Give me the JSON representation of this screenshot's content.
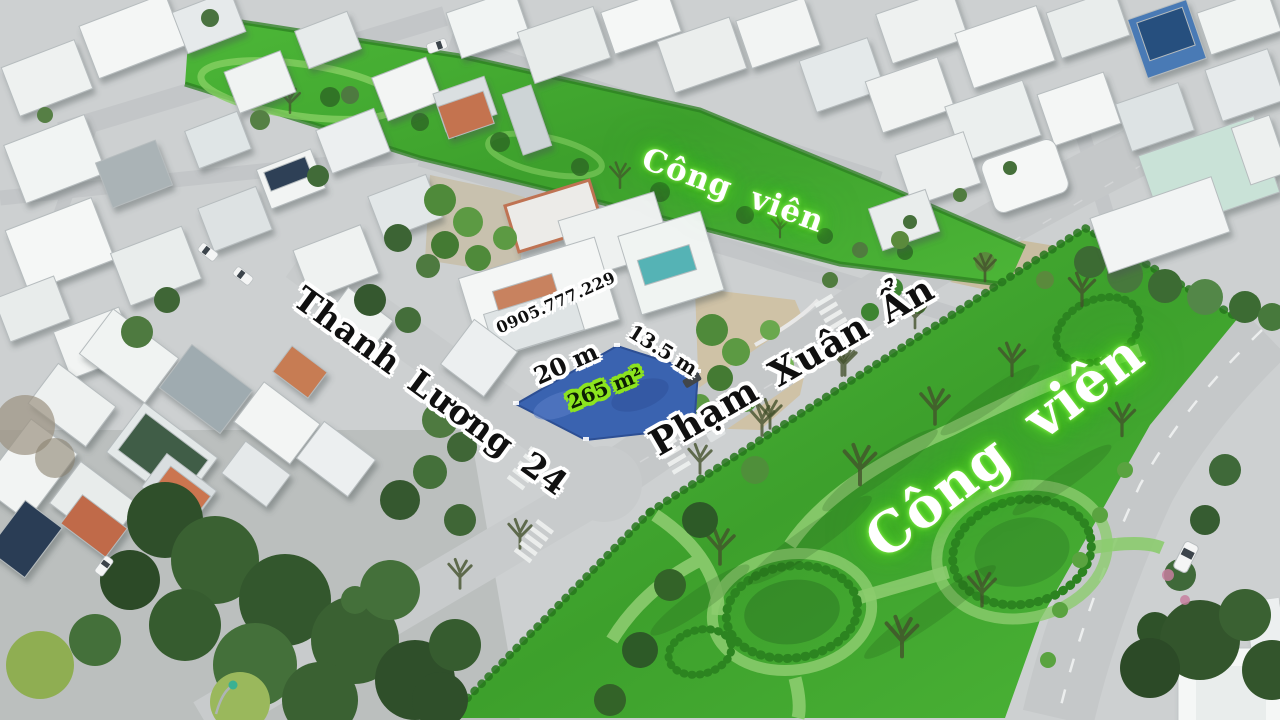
{
  "photo": {
    "type": "aerial-drone-photo-of-residential-land-listing",
    "labels": {
      "park_top": "Công viên",
      "park_right": "Công viên",
      "street_left": "Thanh Lương 24",
      "street_right": "Phạm Xuân Ẩn",
      "phone": "0905.777.229",
      "frontage": "20 m",
      "depth": "13.5 m",
      "area": "265 m²"
    },
    "colors": {
      "park_highlight_green": "#4db838",
      "plot_highlight_blue": "#3a63b0",
      "area_outline_green": "#8ce41f",
      "label_text_black": "#101010",
      "label_text_white": "#ffffff"
    }
  }
}
